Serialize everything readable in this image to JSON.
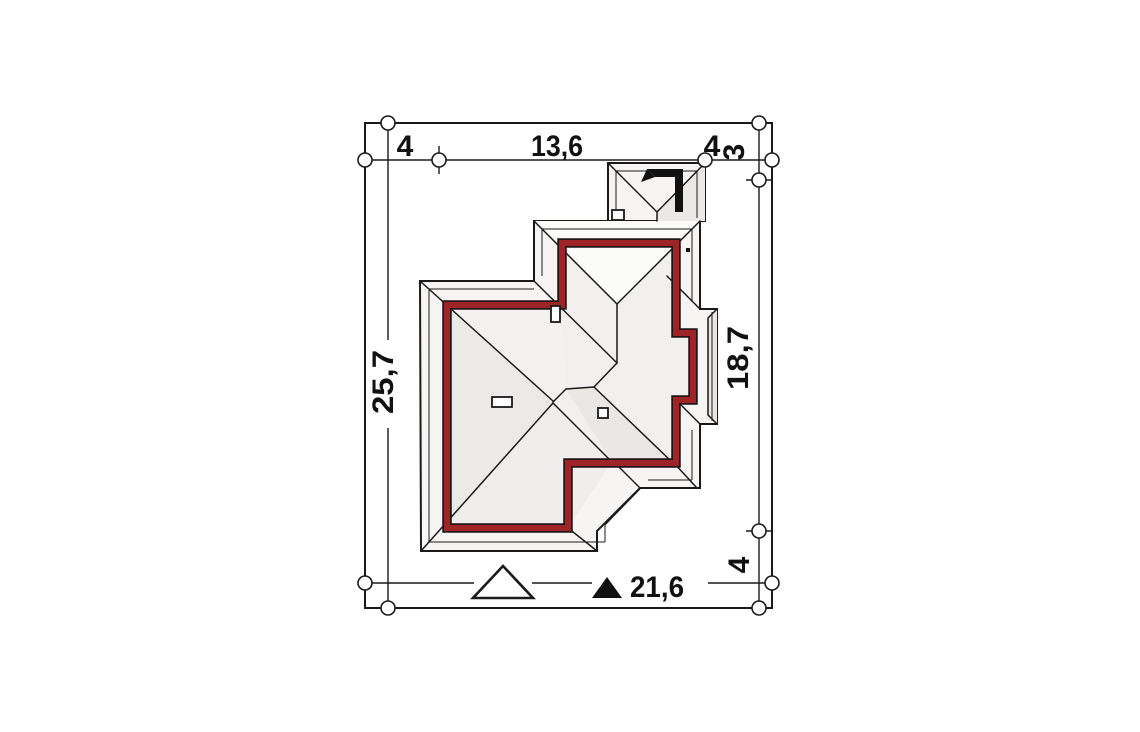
{
  "site_plan": {
    "labels": {
      "top_left_setback": "4",
      "top_building_width": "13,6",
      "top_right_setback": "4",
      "right_top_setback": "3",
      "plot_depth": "25,7",
      "building_depth": "18,7",
      "right_bottom_setback": "4",
      "building_total_width": "21,6"
    },
    "markers": {
      "north_arrow": "north-direction-arrow",
      "entrance_triangle": "main-entrance-marker",
      "dimension_triangle": "filled-dimension-marker"
    },
    "colors": {
      "wall_outline": "#9e2428",
      "drawing_line": "#1a1a1a",
      "roof_fill": "#f6f5f3",
      "roof_shade": "#e9e8e5",
      "background": "#ffffff"
    }
  }
}
